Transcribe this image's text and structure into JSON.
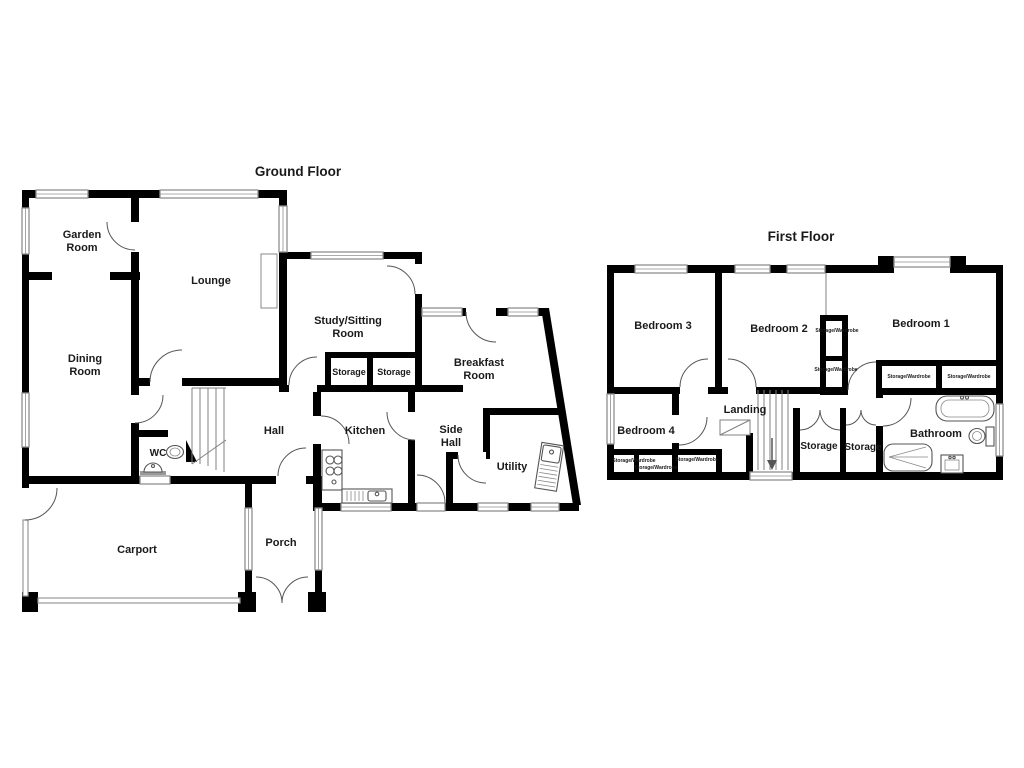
{
  "titles": {
    "ground_floor": "Ground Floor",
    "first_floor": "First Floor"
  },
  "ground_floor": {
    "rooms": {
      "garden_room": [
        "Garden",
        "Room"
      ],
      "lounge": "Lounge",
      "dining_room": [
        "Dining",
        "Room"
      ],
      "study_sitting_room": [
        "Study/Sitting",
        "Room"
      ],
      "storage_left": "Storage",
      "storage_right": "Storage",
      "breakfast_room": [
        "Breakfast",
        "Room"
      ],
      "kitchen": "Kitchen",
      "side_hall": [
        "Side",
        "Hall"
      ],
      "utility": "Utility",
      "hall": "Hall",
      "wc": "WC",
      "carport": "Carport",
      "porch": "Porch"
    }
  },
  "first_floor": {
    "rooms": {
      "bedroom_1": "Bedroom 1",
      "bedroom_2": "Bedroom 2",
      "bedroom_3": "Bedroom 3",
      "bedroom_4": "Bedroom 4",
      "landing": "Landing",
      "bathroom": "Bathroom",
      "storage_left": "Storage",
      "storage_right": "Storage",
      "storage_wardrobe": "Storage/Wardrobe"
    }
  },
  "colors": {
    "wall": "#000000",
    "window": "#8f8f8f",
    "background": "#ffffff"
  }
}
